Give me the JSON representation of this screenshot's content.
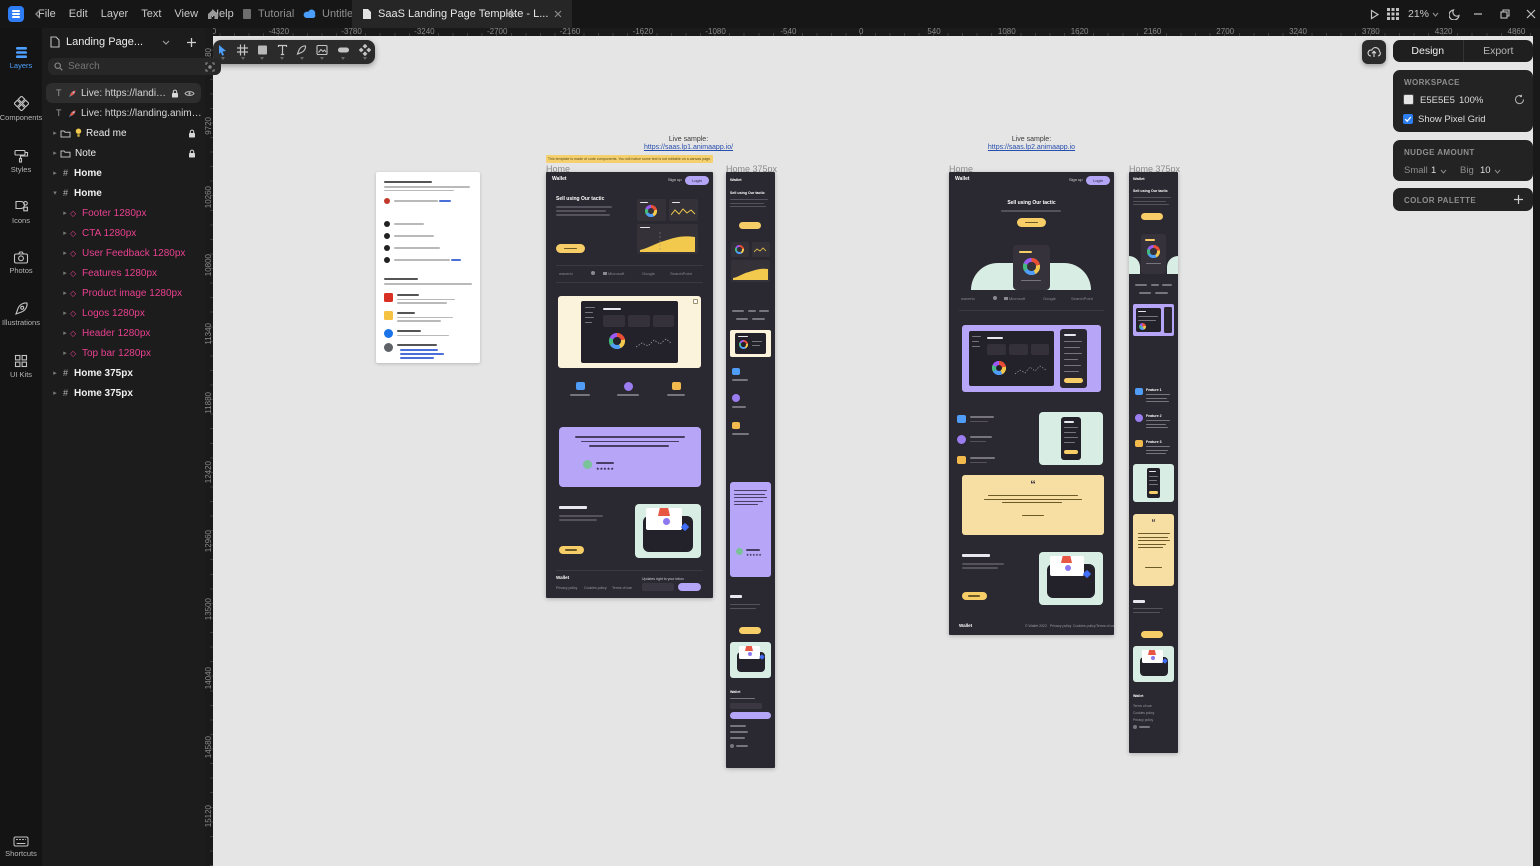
{
  "topbar": {
    "menus": [
      "File",
      "Edit",
      "Layer",
      "Text",
      "View",
      "Help"
    ],
    "tabs": {
      "tutorial": "Tutorial",
      "untitled": "Untitled",
      "active": "SaaS Landing Page Template - L..."
    },
    "zoom": "21%"
  },
  "rail": {
    "items": [
      "Layers",
      "Components",
      "Styles",
      "Icons",
      "Photos",
      "Illustrations",
      "UI Kits"
    ],
    "shortcuts": "Shortcuts"
  },
  "layers": {
    "project": "Landing Page...",
    "search_placeholder": "Search",
    "rows": [
      {
        "label": "Live: https://landing..."
      },
      {
        "label": "Live: https://landing.anima..."
      },
      {
        "label": "Read me"
      },
      {
        "label": "Note"
      },
      {
        "label": "Home"
      },
      {
        "label": "Home"
      },
      {
        "label": "Footer 1280px"
      },
      {
        "label": "CTA 1280px"
      },
      {
        "label": "User Feedback 1280px"
      },
      {
        "label": "Features 1280px"
      },
      {
        "label": "Product image 1280px"
      },
      {
        "label": "Logos 1280px"
      },
      {
        "label": "Header 1280px"
      },
      {
        "label": "Top bar 1280px"
      },
      {
        "label": "Home 375px"
      },
      {
        "label": "Home 375px"
      }
    ]
  },
  "rulers": {
    "horizontal": [
      "-4860",
      "-4320",
      "-3780",
      "-3240",
      "-2700",
      "-2160",
      "-1620",
      "-1080",
      "-540",
      "0",
      "540",
      "1080",
      "1620",
      "2160",
      "2700",
      "3240",
      "3780",
      "4320",
      "4860"
    ],
    "vertical": [
      "9180",
      "9720",
      "10260",
      "10800",
      "11340",
      "11880",
      "12420",
      "12960",
      "13500",
      "14040",
      "14580",
      "15120"
    ]
  },
  "canvas": {
    "desktop_label": "Home",
    "mobile_label": "Home 375px",
    "live1": {
      "caption": "Live sample:",
      "url": "https://saas.lp1.animaapp.io/"
    },
    "live2": {
      "caption": "Live sample:",
      "url": "https://saas.lp2.animaapp.io"
    },
    "banner": "This template is made of code components. You will notice some text is not editable on a canvas page.",
    "site": {
      "brand": "Wallet",
      "signup": "Sign up",
      "login": "Login",
      "hero_title": "Sell using Our tactic",
      "logos": [
        "waverio",
        "Microsoft",
        "Google",
        "SearchPoint"
      ],
      "stars": "★★★★★",
      "quote_mark": "“",
      "features": [
        "Feature 1",
        "Feature 2",
        "Feature 3"
      ],
      "footer_links": [
        "Privacy policy",
        "Cookies policy",
        "Terms of use"
      ],
      "footer_note": "© Wallet 2022",
      "newsletter": "Updates right to your inbox"
    }
  },
  "right_panel": {
    "tabs": [
      "Design",
      "Export"
    ],
    "workspace": {
      "title": "WORKSPACE",
      "hex": "E5E5E5",
      "percent": "100%",
      "pixel_grid": "Show Pixel Grid"
    },
    "nudge": {
      "title": "NUDGE AMOUNT",
      "small_label": "Small",
      "small_value": "1",
      "big_label": "Big",
      "big_value": "10"
    },
    "palette_title": "COLOR PALETTE"
  },
  "colors": {
    "accent_blue": "#4da0ff",
    "component_pink": "#e8418f",
    "workspace_gray": "#e5e5e5",
    "brand_yellow": "#f6cd67",
    "brand_purple": "#b7a5f7",
    "mint": "#d8eee4",
    "cream": "#fbf3db",
    "quote_card": "#f7dfa4",
    "checkbox_blue": "#2d7ff0"
  }
}
